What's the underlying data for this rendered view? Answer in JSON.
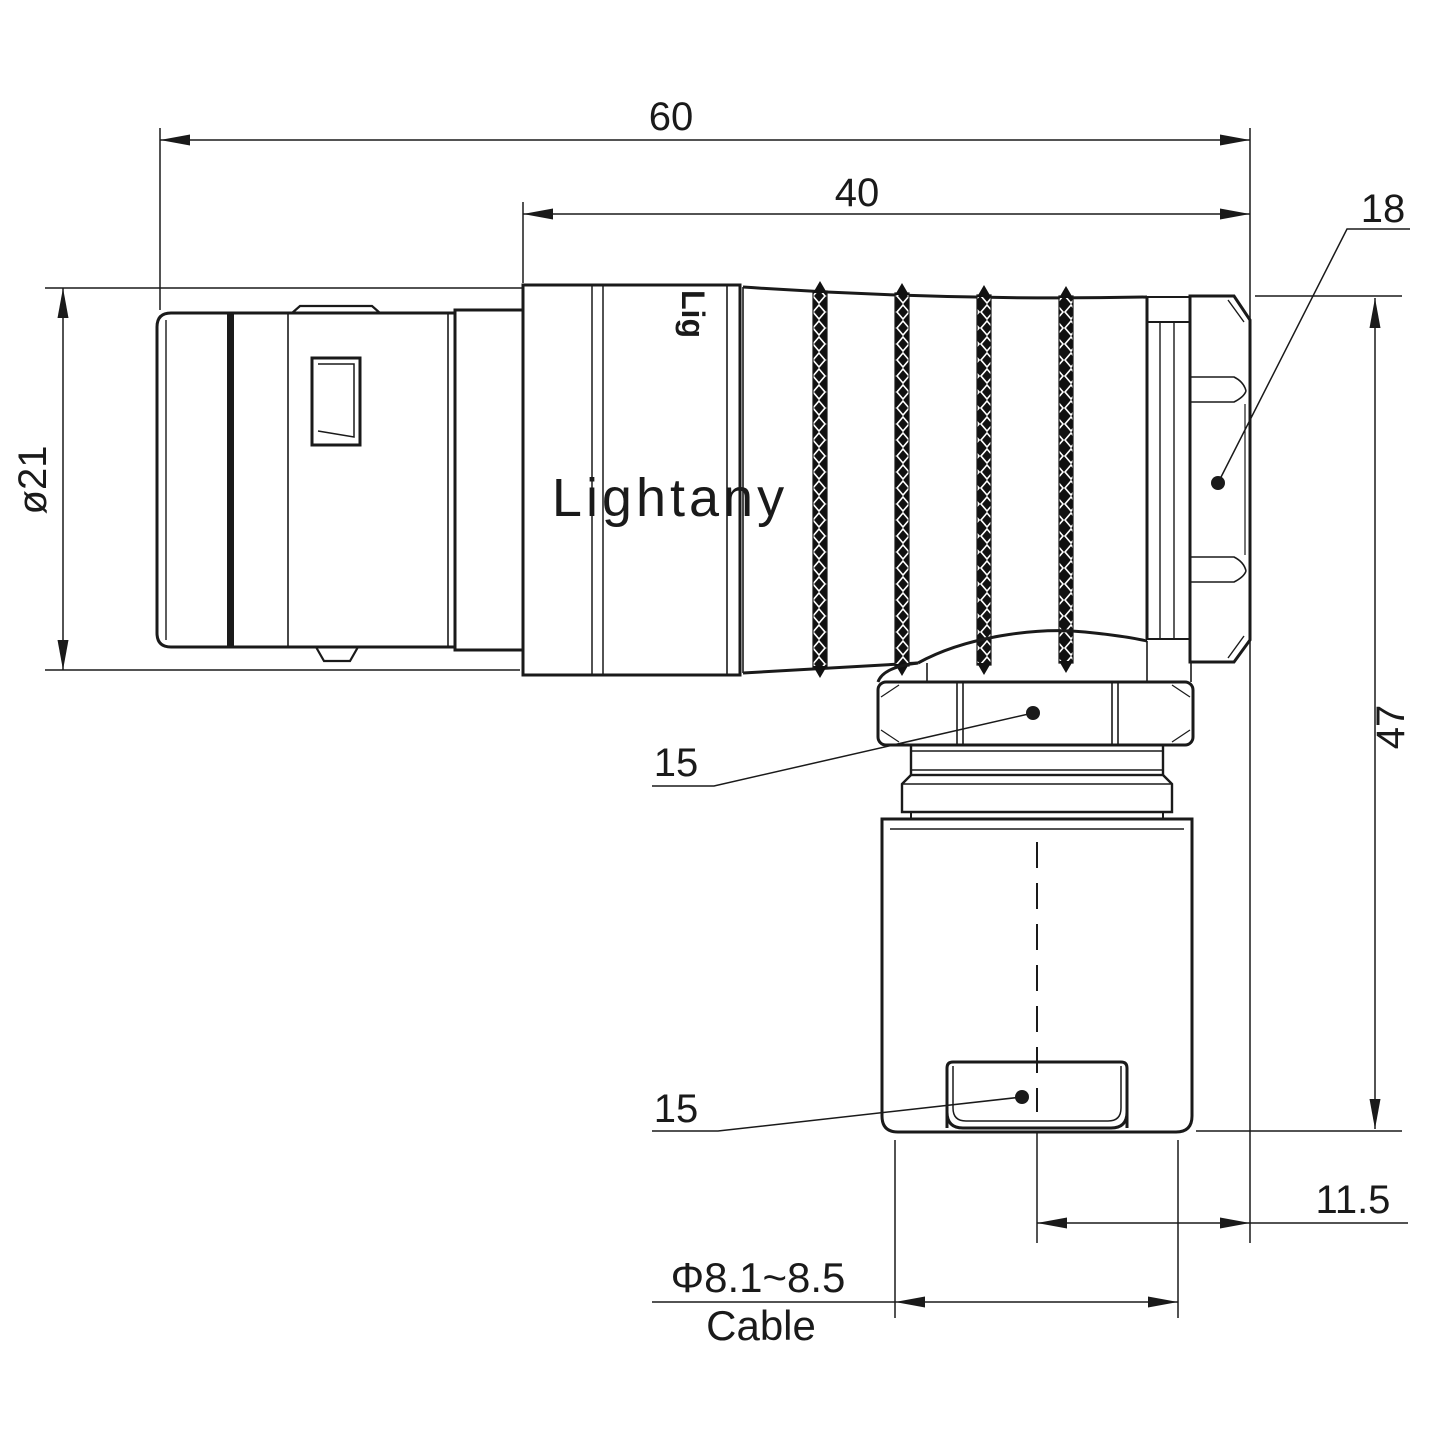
{
  "page": {
    "background": "#ffffff",
    "title": "Right-angle circular connector dimensional drawing"
  },
  "watermark": {
    "text": "Lightany",
    "color": "#f2c7c7"
  },
  "body_print": "Lig",
  "dims": {
    "overall_length": "60",
    "rear_length": "40",
    "nut_width": "18",
    "front_diameter": "ø21",
    "overall_height": "47",
    "elbow_hex": "15",
    "clamp_hex": "15",
    "exit_offset": "11.5",
    "cable_range": "Φ8.1~8.5",
    "cable_word": "Cable"
  },
  "colors": {
    "line": "#1a1a1a"
  }
}
